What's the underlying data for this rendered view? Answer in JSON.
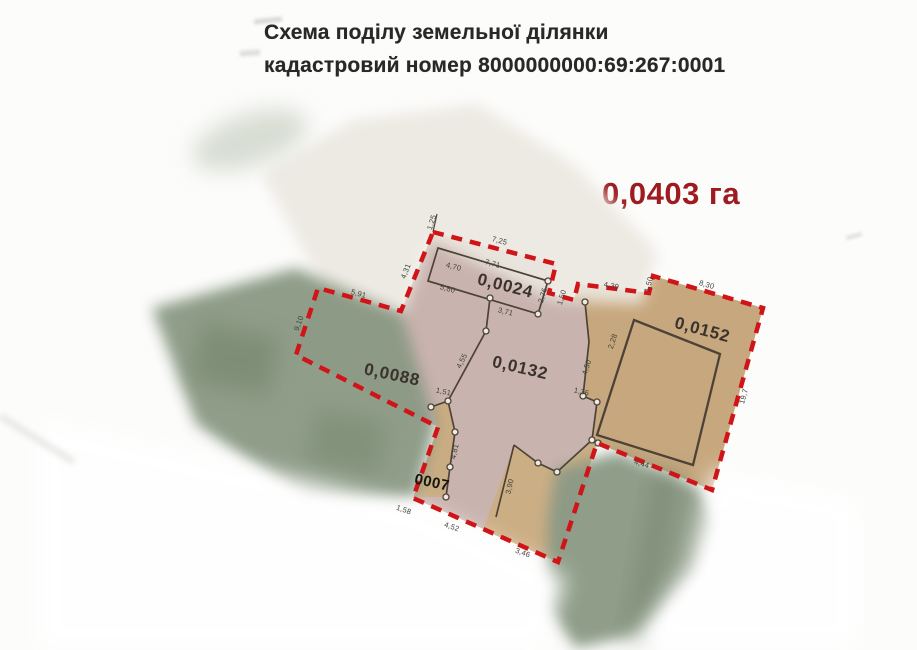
{
  "title": {
    "line1": "Схема поділу земельної ділянки",
    "line2": "кадастровий номер 8000000000:69:267:0001"
  },
  "total_area": "0,0403 га",
  "parcels": [
    {
      "area_label": "0,0024"
    },
    {
      "area_label": "0,0088"
    },
    {
      "area_label": "0,0132"
    },
    {
      "area_label": "0,0152"
    },
    {
      "area_label": "0007"
    }
  ],
  "dims": [
    {
      "t": "1,25"
    },
    {
      "t": "7,25"
    },
    {
      "t": "7,71"
    },
    {
      "t": "4,70"
    },
    {
      "t": "5,80"
    },
    {
      "t": "3,71"
    },
    {
      "t": "2,76"
    },
    {
      "t": "1,50"
    },
    {
      "t": "4,39"
    },
    {
      "t": "1,50"
    },
    {
      "t": "8,30"
    },
    {
      "t": "5,91"
    },
    {
      "t": "4,31"
    },
    {
      "t": "9,10"
    },
    {
      "t": "4,55"
    },
    {
      "t": "2,28"
    },
    {
      "t": "4,50"
    },
    {
      "t": "1,51"
    },
    {
      "t": "4,81"
    },
    {
      "t": "1,36"
    },
    {
      "t": "19,7"
    },
    {
      "t": "4,44"
    },
    {
      "t": "3,90"
    },
    {
      "t": "1,58"
    },
    {
      "t": "4,52"
    },
    {
      "t": "3,46"
    }
  ],
  "colors": {
    "boundary_red": "#d01418",
    "total_area_red": "#9e1b20",
    "parcel_mauve": "#c9b3ae",
    "parcel_tan": "#c7a77d",
    "strip_tan": "#ccae85",
    "neighbor_green": "#8b9a85",
    "line_dark": "#4d4338"
  }
}
